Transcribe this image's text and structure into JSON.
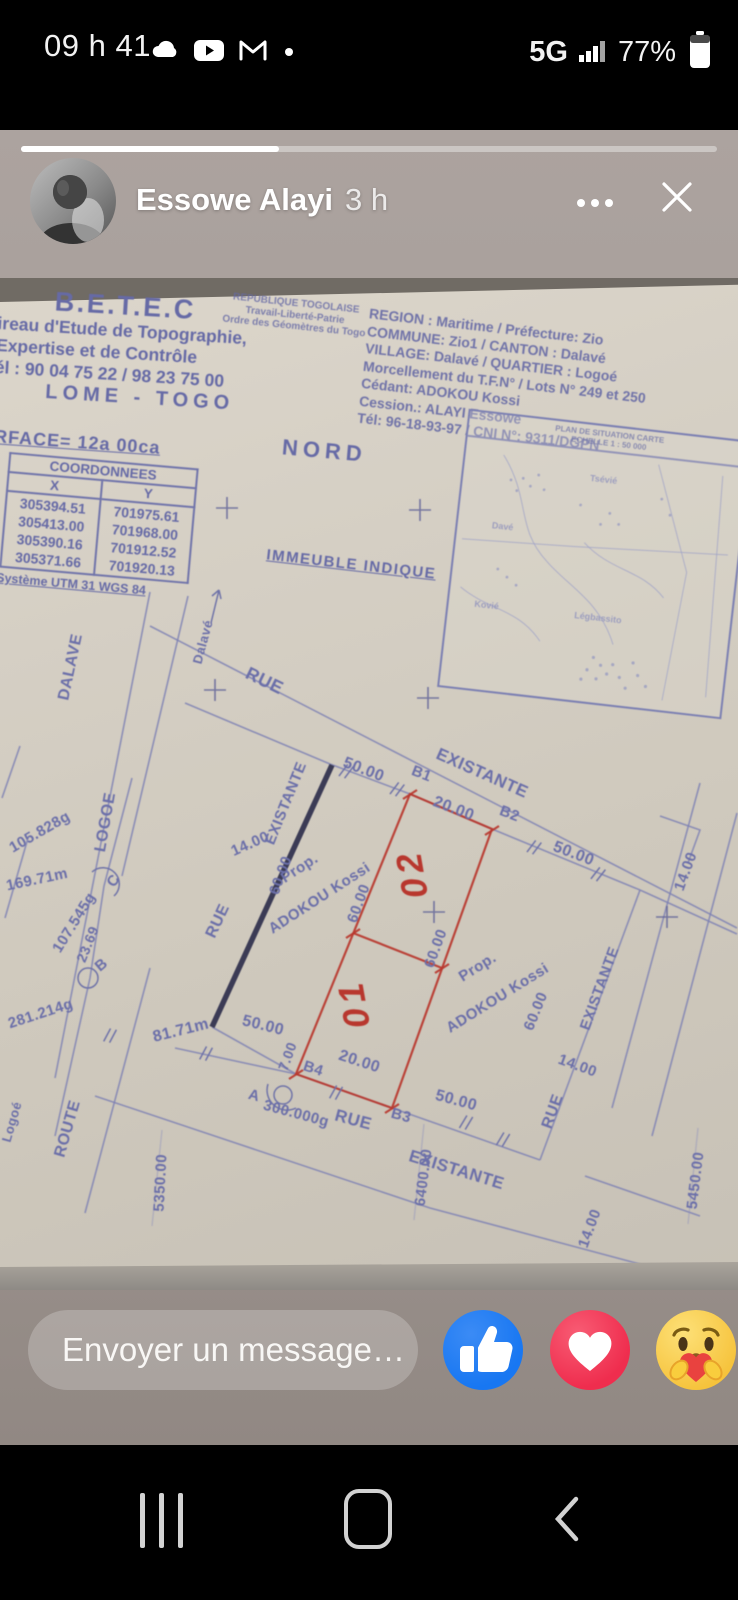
{
  "status_bar": {
    "time": "09 h 41",
    "network": "5G",
    "battery": "77%"
  },
  "story": {
    "author": "Essowe Alayi",
    "time_ago": "3 h",
    "progress_pct": 37
  },
  "composer": {
    "placeholder": "Envoyer un message…"
  },
  "icons": {
    "status": [
      "cloud-icon",
      "youtube-icon",
      "gmail-icon",
      "notification-dot-icon",
      "signal-bars-icon",
      "battery-icon"
    ],
    "header": [
      "more-icon",
      "close-icon"
    ],
    "reactions": [
      "like-thumb-icon",
      "love-heart-icon",
      "care-hug-icon"
    ],
    "nav": [
      "recents-icon",
      "home-icon",
      "back-icon"
    ]
  },
  "colors": {
    "accent_blue": "#1877f2",
    "love_red": "#ef2d4e",
    "care_yellow": "#f6c33c",
    "paper": "#d2ccc0",
    "ink": "#6b6fa9",
    "red_ink": "#b8372e",
    "story_bg": "#a19894"
  },
  "document": {
    "letterhead": {
      "title": "B.E.T.E.C",
      "line1": "ireau d'Etude de Topographie,",
      "line2": "Expertise et de Contrôle",
      "line3": "él : 90 04 75 22 / 98 23 75 00",
      "city": "LOME - TOGO"
    },
    "republic": {
      "line1": "REPUBLIQUE TOGOLAISE",
      "line2": "Travail-Liberté-Patrie",
      "line3": "Ordre des Géomètres du Togo"
    },
    "property": {
      "lines": [
        "REGION : Maritime / Préfecture: Zio",
        "COMMUNE: Zio1  / CANTON : Dalavé",
        "VILLAGE: Dalavé / QUARTIER : Logoé",
        "Morcellement du T.F.N° / Lots N° 249 et 250",
        "Cédant: ADOKOU Kossi",
        "Cession.: ALAYI Essowe",
        "Tél: 96-18-93-97  / CNI N°: 9311/DGPN"
      ]
    },
    "surface": "RFACE=  12a  00ca",
    "north": "NORD",
    "coordinates": {
      "title": "COORDONNEES",
      "col_x": "X",
      "col_y": "Y",
      "rows": [
        [
          "305394.51",
          "701975.61"
        ],
        [
          "305413.00",
          "701968.00"
        ],
        [
          "305390.16",
          "701912.52"
        ],
        [
          "305371.66",
          "701920.13"
        ]
      ]
    },
    "datum": "Système UTM 31 WGS 84",
    "indicated": "IMMEUBLE INDIQUE",
    "map": {
      "title1": "PLAN DE SITUATION CARTE",
      "title2": "ECHELLE 1 : 50 000",
      "p1": "Tsévié",
      "p2": "Davé",
      "p3": "Kovié",
      "p4": "Légbassito"
    },
    "plan": {
      "road_rue": "RUE",
      "road_route": "ROUTE",
      "road_dalave": "DALAVE",
      "road_logoe": "LOGOE",
      "logoe_small": "Logoé",
      "dalave_small": "Dalavé",
      "existante": "EXISTANTE",
      "d50": "50.00",
      "d20": "20.00",
      "d14": "14.00",
      "d60": "60.00",
      "d7": "7.00",
      "d8171": "81.71m",
      "d16971": "169.71m",
      "d2369": "23.69",
      "a105": "105.828g",
      "a107": "107.545g",
      "a281": "281.214g",
      "a300": "300.000g",
      "pA": "A",
      "pB": "B",
      "pC": "C",
      "pB1": "B1",
      "pB2": "B2",
      "pB3": "B3",
      "pB4": "B4",
      "lot01": "01",
      "lot02": "02",
      "prop": "Prop.",
      "owner": "ADOKOU Kossi",
      "g5350": "5350.00",
      "g6400": "6400.00",
      "g5450": "5450.00"
    }
  }
}
